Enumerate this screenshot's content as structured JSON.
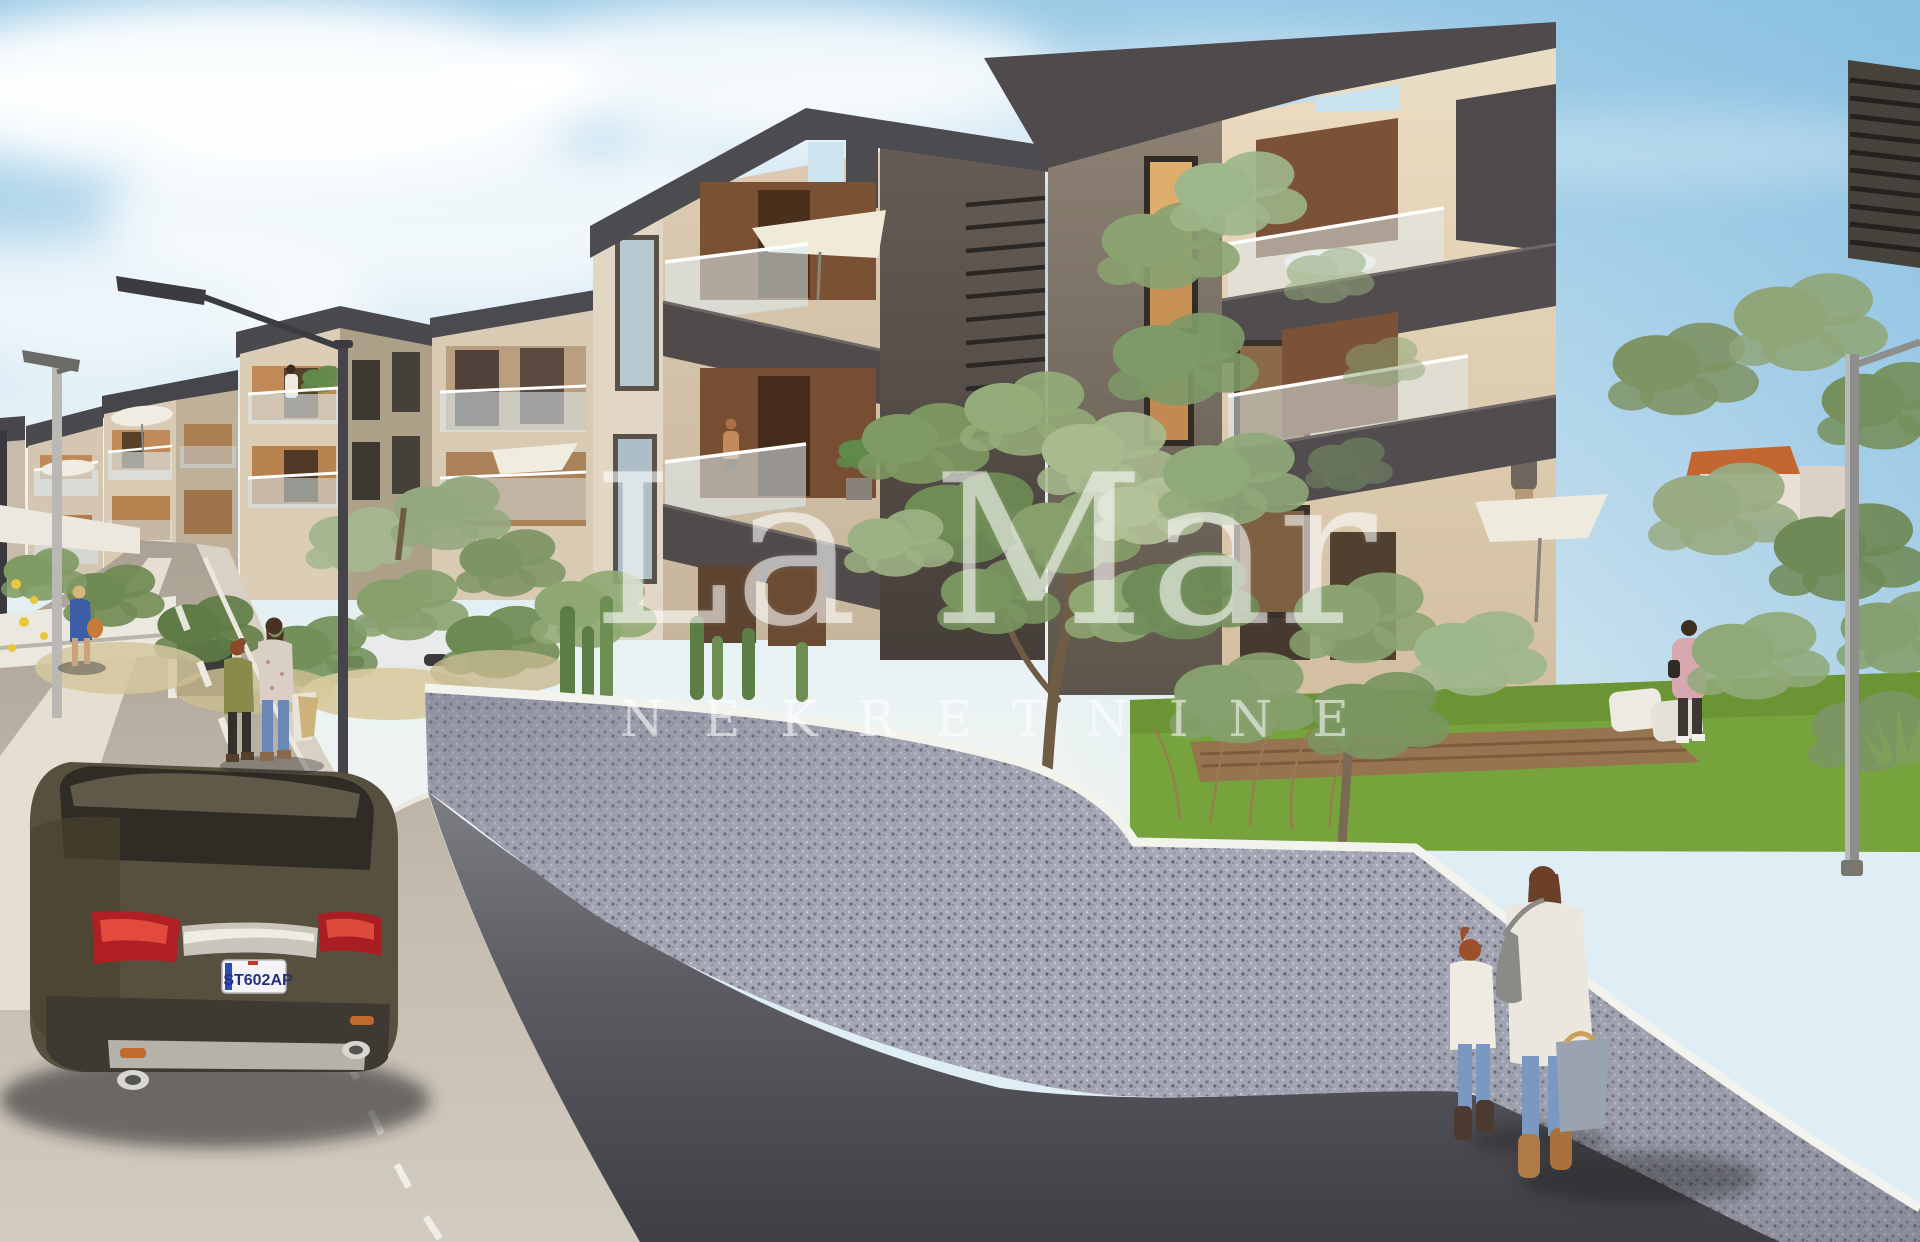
{
  "watermark": {
    "title": "La Mar",
    "subtitle": "NEKRETNINE"
  },
  "vehicle": {
    "license_plate": "ST602AP"
  },
  "palette": {
    "sky_top": "#9ccbe6",
    "sky_horizon": "#eef4f2",
    "anthracite_band": "#4c4b50",
    "beige_wall": "#dcccb4",
    "wood_panel": "#7b5236",
    "foliage": "#8aa371",
    "pebble_wall": "#a4a6b3",
    "asphalt": "#47474c",
    "concrete_road": "#c3bbae",
    "watermark": "rgba(255,255,255,0.55)"
  },
  "scene": {
    "caption": "3D render of a modern Mediterranean apartment complex",
    "elements": [
      "sky",
      "clouds",
      "apartment-buildings",
      "balconies",
      "umbrellas",
      "street-lamps",
      "olive-trees",
      "garden",
      "pebble-retaining-wall",
      "concrete-road",
      "asphalt-road",
      "parked-suv",
      "pedestrians",
      "watermark"
    ]
  }
}
